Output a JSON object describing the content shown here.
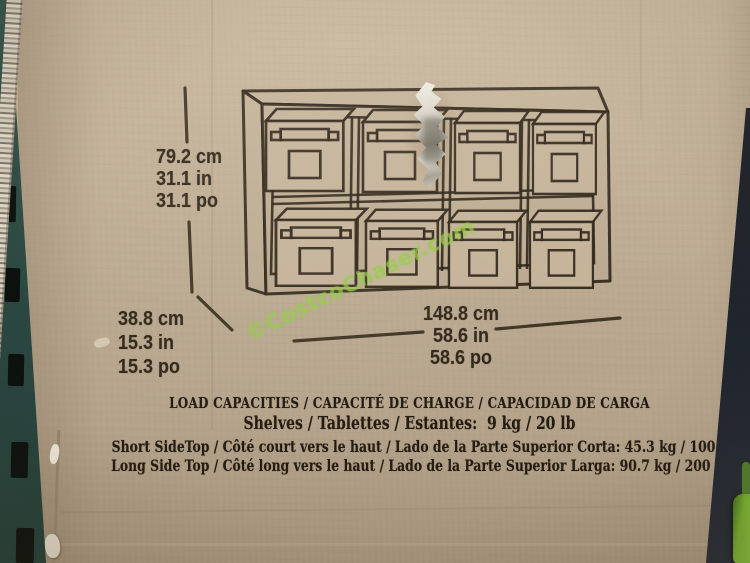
{
  "watermark": "©CostcoChaser.com",
  "cabinet": {
    "rows": 2,
    "columns": 4,
    "bins": 8
  },
  "dims": {
    "height": [
      "79.2 cm",
      "31.1 in",
      "31.1 po"
    ],
    "depth": [
      "38.8 cm",
      "15.3 in",
      "15.3 po"
    ],
    "width": [
      "148.8 cm",
      "58.6 in",
      "58.6 po"
    ]
  },
  "load": {
    "heading": "LOAD CAPACITIES / CAPACITÉ DE CHARGE / CAPACIDAD DE CARGA",
    "shelves": "Shelves / Tablettes / Estantes:  9 kg / 20 lb",
    "short_side": "Short SideTop / Côté court vers le haut / Lado de la Parte Superior Corta: 45.3 kg / 100 lb",
    "long_side": "Long Side Top / Côté long vers le haut / Lado de la Parte Superior Larga: 90.7 kg / 200 lb"
  },
  "colors": {
    "cardboard": "#bdac93",
    "ink": "#2b2216",
    "watermark_green": "#92cb42",
    "rack_teal": "#2c4a44",
    "gap_dark": "#1c222b",
    "green_object": "#8cc63e"
  }
}
